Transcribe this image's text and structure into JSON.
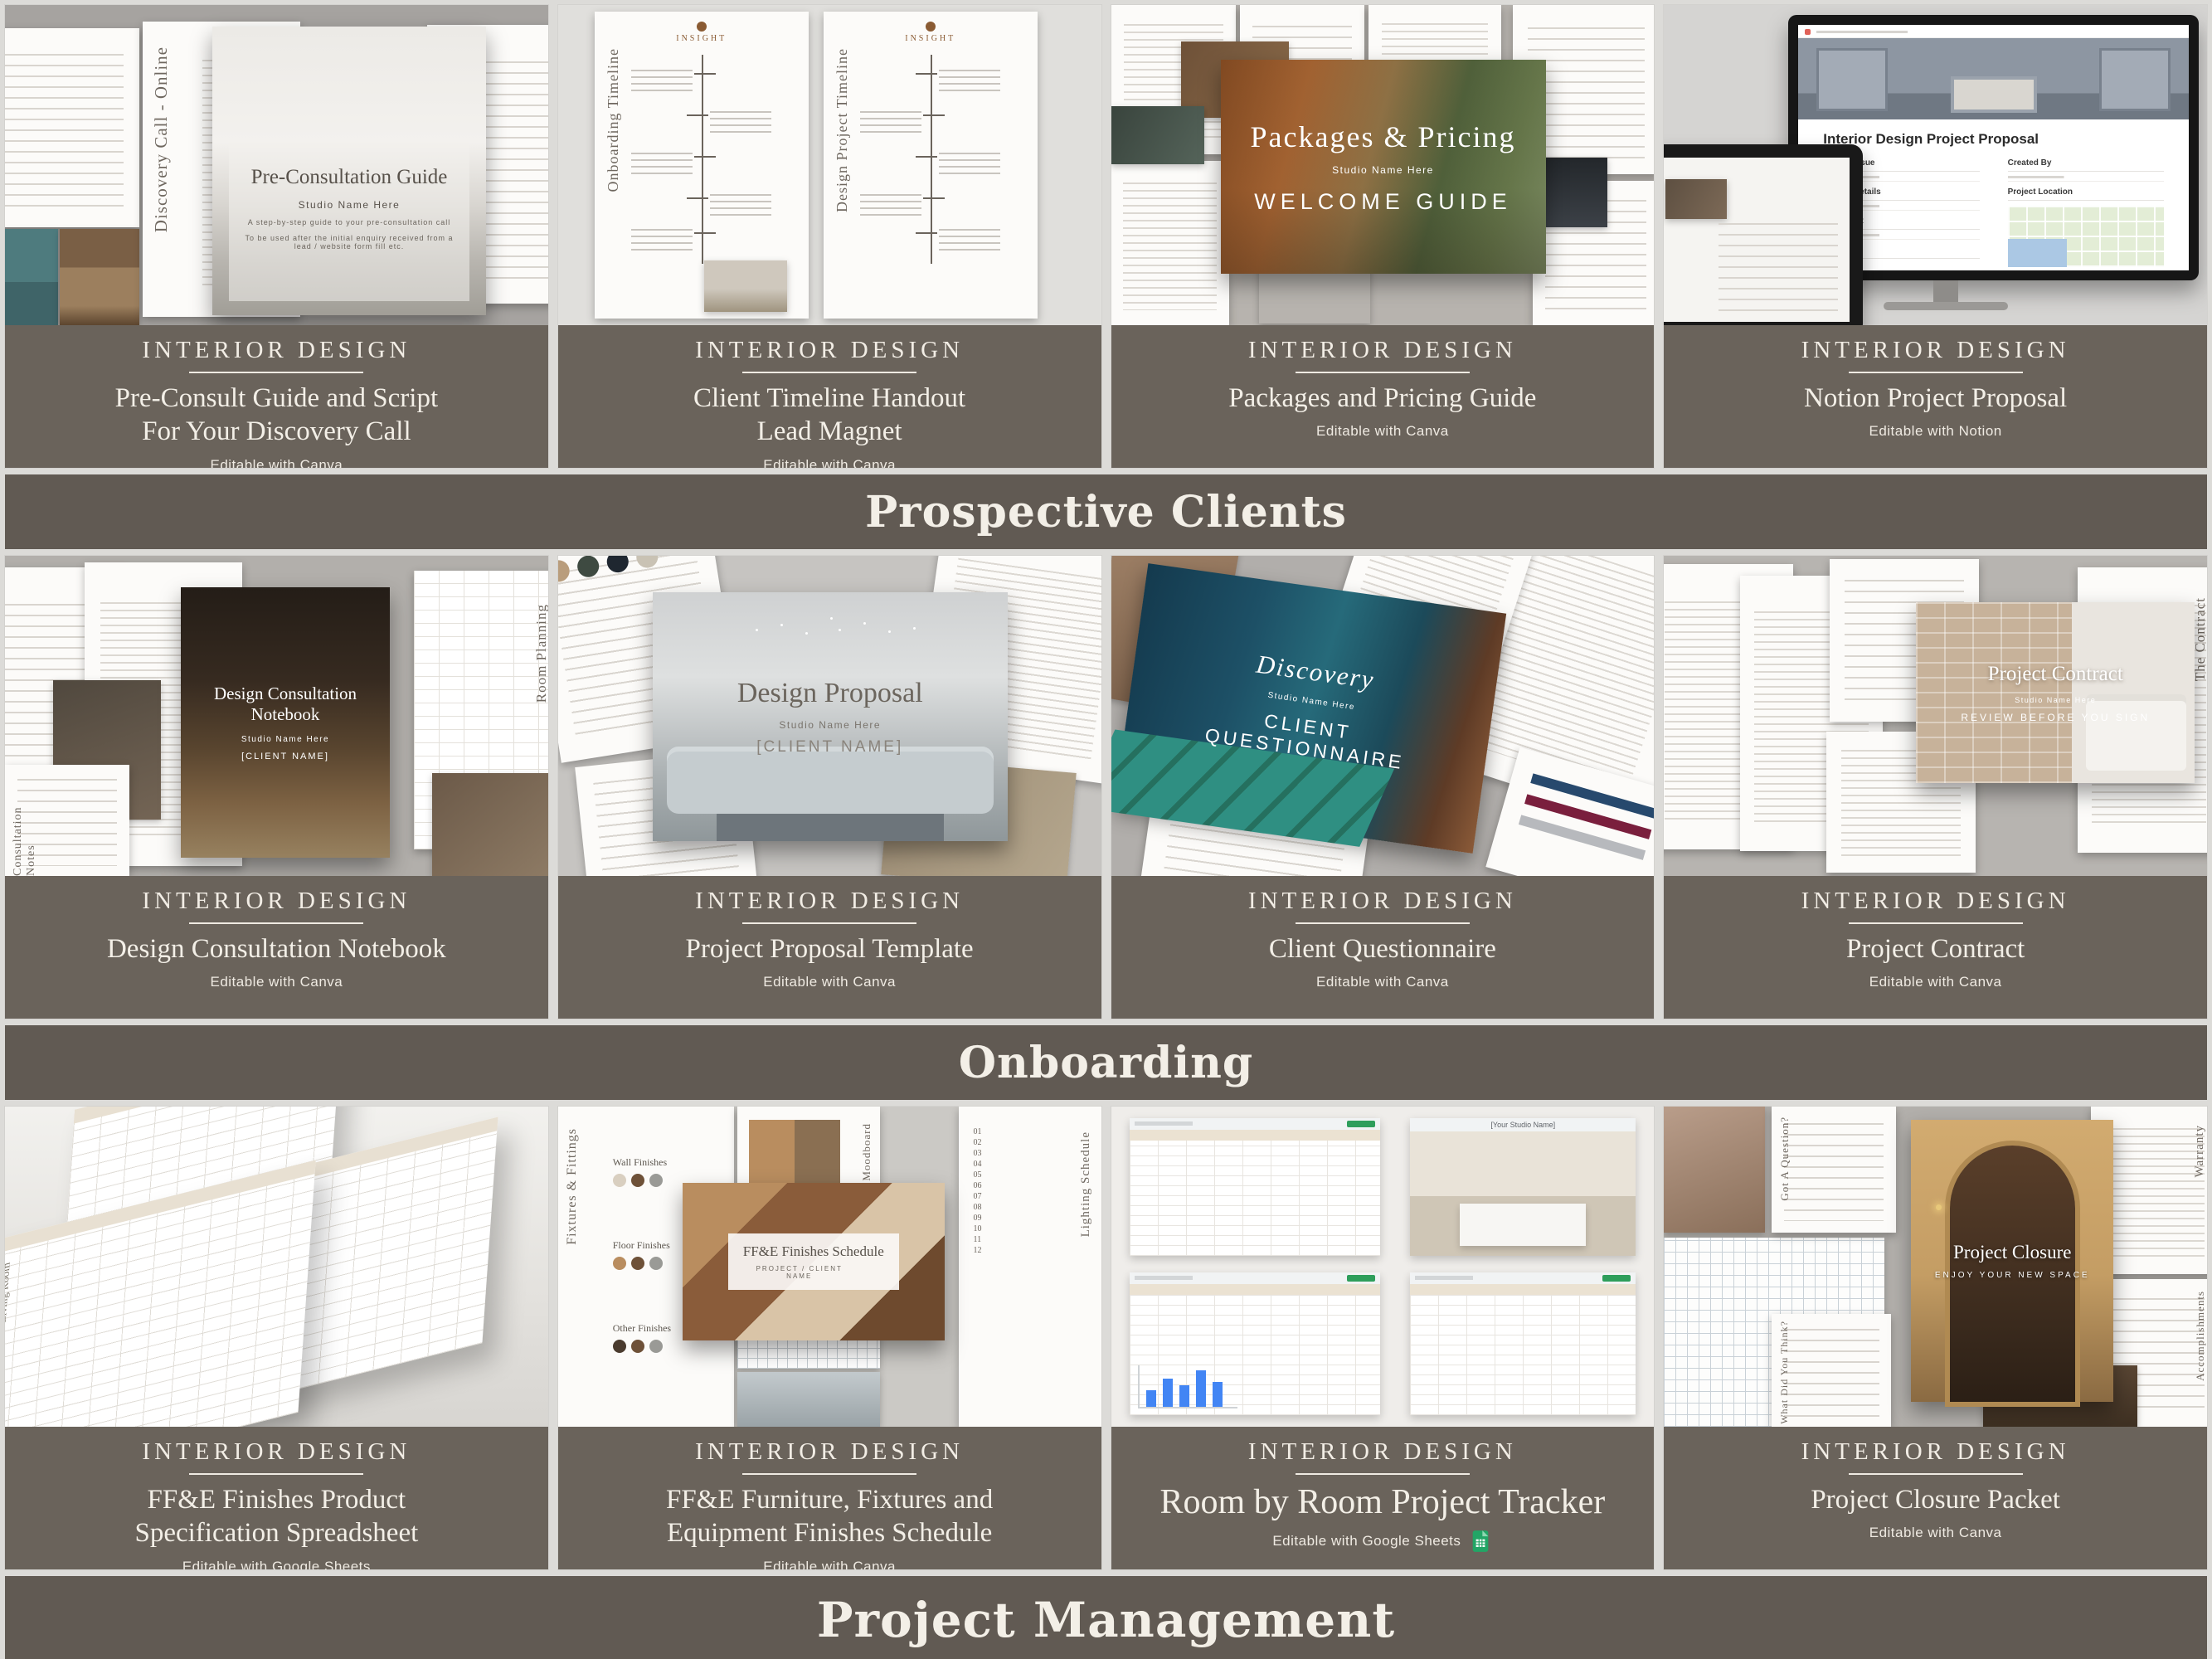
{
  "sections": [
    {
      "label": "Prospective Clients"
    },
    {
      "label": "Onboarding"
    },
    {
      "label": "Project Management"
    }
  ],
  "cards": [
    {
      "eyebrow": "INTERIOR DESIGN",
      "title": "Pre-Consult Guide and Script\nFor Your Discovery Call",
      "note": "Editable with Canva",
      "cover": {
        "title": "Pre-Consultation Guide",
        "studio": "Studio Name Here",
        "line1": "A step-by-step guide to your pre-consultation call",
        "line2": "To be used after the initial enquiry received from a lead / website form fill etc.",
        "vlabel": "Discovery Call - Online"
      }
    },
    {
      "eyebrow": "INTERIOR DESIGN",
      "title": "Client Timeline Handout\nLead Magnet",
      "note": "Editable with Canva",
      "cover": {
        "logo": "INSIGHT",
        "vlabel1": "Onboarding Timeline",
        "vlabel2": "Design Project Timeline"
      }
    },
    {
      "eyebrow": "INTERIOR DESIGN",
      "title": "Packages and Pricing Guide",
      "note": "Editable with Canva",
      "cover": {
        "title": "Packages & Pricing",
        "studio": "Studio Name Here",
        "line1": "WELCOME GUIDE"
      }
    },
    {
      "eyebrow": "INTERIOR DESIGN",
      "title": "Notion Project Proposal",
      "note": "Editable with Notion",
      "cover": {
        "screen_title": "Interior Design Project Proposal",
        "fields": [
          "Date of Issue",
          "Created By",
          "Project Details",
          "Project Location",
          "The Client",
          "Timeline"
        ]
      }
    },
    {
      "eyebrow": "INTERIOR DESIGN",
      "title": "Design Consultation Notebook",
      "note": "Editable with Canva",
      "cover": {
        "title": "Design Consultation Notebook",
        "studio": "Studio Name Here",
        "line1": "[CLIENT NAME]",
        "vlabel1": "Consultation Notes",
        "vlabel2": "Room Planning"
      }
    },
    {
      "eyebrow": "INTERIOR DESIGN",
      "title": "Project Proposal Template",
      "note": "Editable with Canva",
      "cover": {
        "title": "Design Proposal",
        "studio": "Studio Name Here",
        "line1": "[CLIENT NAME]"
      }
    },
    {
      "eyebrow": "INTERIOR DESIGN",
      "title": "Client Questionnaire",
      "note": "Editable with Canva",
      "cover": {
        "title": "Discovery",
        "studio": "Studio Name Here",
        "line1": "CLIENT QUESTIONNAIRE",
        "vlabel": "Kitchen Design"
      }
    },
    {
      "eyebrow": "INTERIOR DESIGN",
      "title": "Project Contract",
      "note": "Editable with Canva",
      "cover": {
        "title": "Project Contract",
        "studio": "Studio Name Here",
        "line1": "REVIEW BEFORE YOU SIGN",
        "vlabel": "The Contract"
      }
    },
    {
      "eyebrow": "INTERIOR DESIGN",
      "title": "FF&E Finishes Product\nSpecification Spreadsheet",
      "note": "Editable with Google Sheets",
      "cover": {
        "sheet1_label": "Living Room",
        "sheet2_label": "Living Furniture"
      }
    },
    {
      "eyebrow": "INTERIOR DESIGN",
      "title": "FF&E Furniture, Fixtures and\nEquipment Finishes Schedule",
      "note": "Editable with Canva",
      "cover": {
        "title": "FF&E Finishes Schedule",
        "line1": "PROJECT / CLIENT NAME",
        "vlabel1": "Fixtures & Fittings",
        "vlabel2": "Moodboard",
        "vlabel3": "Lighting Schedule",
        "finishes": [
          "Wall Finishes",
          "Floor Finishes",
          "Other Finishes"
        ],
        "numbers": "01\n02\n03\n04\n05\n06\n07\n08\n09\n10\n11\n12"
      }
    },
    {
      "eyebrow": "INTERIOR DESIGN",
      "title": "Room by Room Project Tracker",
      "note": "Editable with Google Sheets",
      "cover": {
        "header": "[Your Studio Name]"
      }
    },
    {
      "eyebrow": "INTERIOR DESIGN",
      "title": "Project Closure Packet",
      "note": "Editable with Canva",
      "cover": {
        "title": "Project Closure",
        "line1": "ENJOY YOUR NEW SPACE",
        "vlabel1": "Warranty",
        "vlabel2": "Got A Question?",
        "vlabel3": "What Did You Think?",
        "vlabel4": "Accomplishments"
      }
    }
  ],
  "colors": {
    "card_banner": "#6a635b",
    "section_banner": "#615a53",
    "page_bg": "#dcdbd8",
    "text_cream": "#f3efe7",
    "sheets_green": "#23a566"
  }
}
